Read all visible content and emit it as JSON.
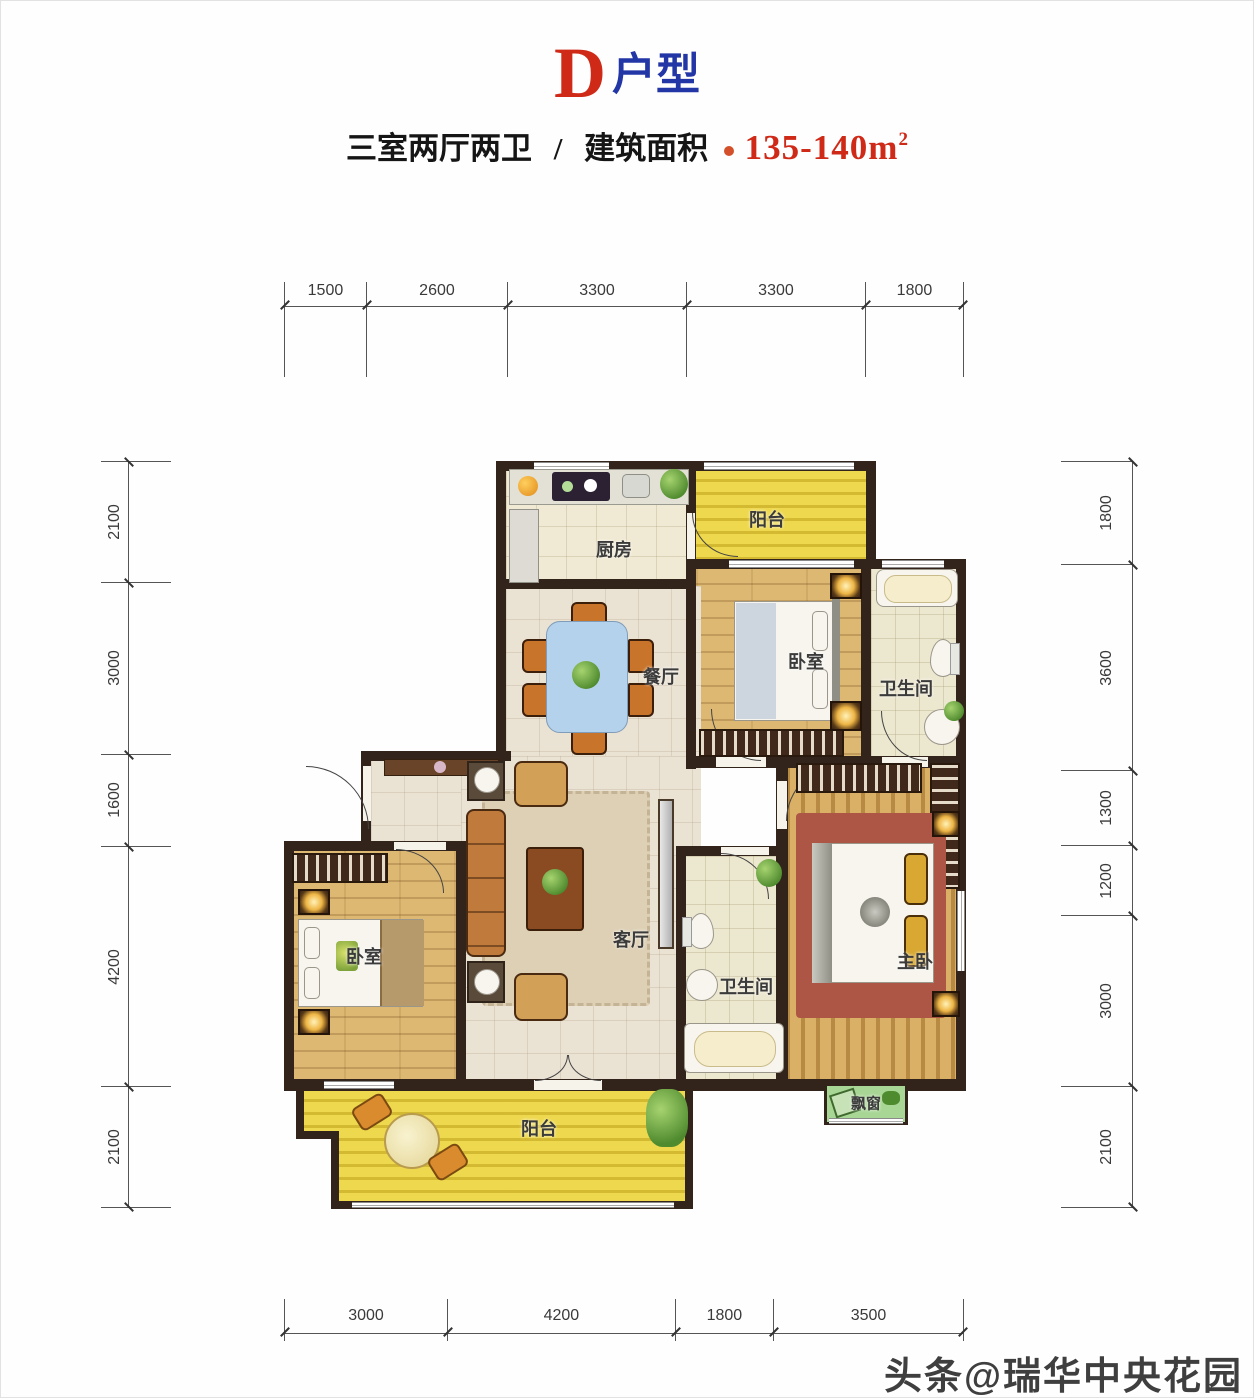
{
  "header": {
    "unit_letter": "D",
    "unit_type_suffix": "户型",
    "layout_text": "三室两厅两卫",
    "divider": "/",
    "area_label": "建筑面积",
    "area_value": "135-140m",
    "area_superscript": "2"
  },
  "dimensions": {
    "top": [
      {
        "label": "1500",
        "mm": 1500
      },
      {
        "label": "2600",
        "mm": 2600
      },
      {
        "label": "3300",
        "mm": 3300
      },
      {
        "label": "3300",
        "mm": 3300
      },
      {
        "label": "1800",
        "mm": 1800
      }
    ],
    "bottom": [
      {
        "label": "3000",
        "mm": 3000
      },
      {
        "label": "4200",
        "mm": 4200
      },
      {
        "label": "1800",
        "mm": 1800
      },
      {
        "label": "3500",
        "mm": 3500
      }
    ],
    "left": [
      {
        "label": "2100",
        "mm": 2100
      },
      {
        "label": "3000",
        "mm": 3000
      },
      {
        "label": "1600",
        "mm": 1600
      },
      {
        "label": "4200",
        "mm": 4200
      },
      {
        "label": "2100",
        "mm": 2100
      }
    ],
    "right": [
      {
        "label": "1800",
        "mm": 1800
      },
      {
        "label": "3600",
        "mm": 3600
      },
      {
        "label": "1300",
        "mm": 1300
      },
      {
        "label": "1200",
        "mm": 1200
      },
      {
        "label": "3000",
        "mm": 3000
      },
      {
        "label": "2100",
        "mm": 2100
      }
    ]
  },
  "rooms": {
    "balcony_top": {
      "label": "阳台"
    },
    "kitchen": {
      "label": "厨房"
    },
    "dining": {
      "label": "餐厅"
    },
    "bedroom_right": {
      "label": "卧室"
    },
    "bathroom_right": {
      "label": "卫生间"
    },
    "bedroom_left": {
      "label": "卧室"
    },
    "living": {
      "label": "客厅"
    },
    "bathroom_center": {
      "label": "卫生间"
    },
    "master_bedroom": {
      "label": "主卧"
    },
    "bay_window": {
      "label": "飘窗"
    },
    "balcony_bottom": {
      "label": "阳台"
    }
  },
  "watermark": {
    "text": "头条@瑞华中央花园"
  },
  "colors": {
    "accent_red": "#cf2a18",
    "accent_blue": "#2336a6",
    "wall": "#33241b",
    "balcony_yellow": "#eed84e",
    "wood": "#dcb873",
    "bay_green": "#a8d695"
  }
}
